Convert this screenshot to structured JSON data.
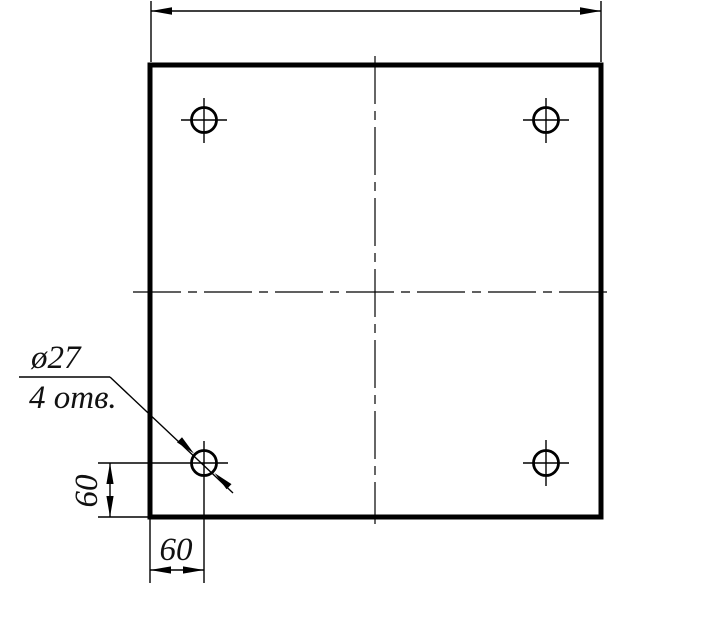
{
  "colors": {
    "background": "#ffffff",
    "lines": "#000000"
  },
  "callout": {
    "line1": "ø27",
    "line2": "4 отв."
  },
  "dims": {
    "vertical_offset": "60",
    "horizontal_offset": "60"
  },
  "holes": {
    "count": 4,
    "diameter": 27
  }
}
